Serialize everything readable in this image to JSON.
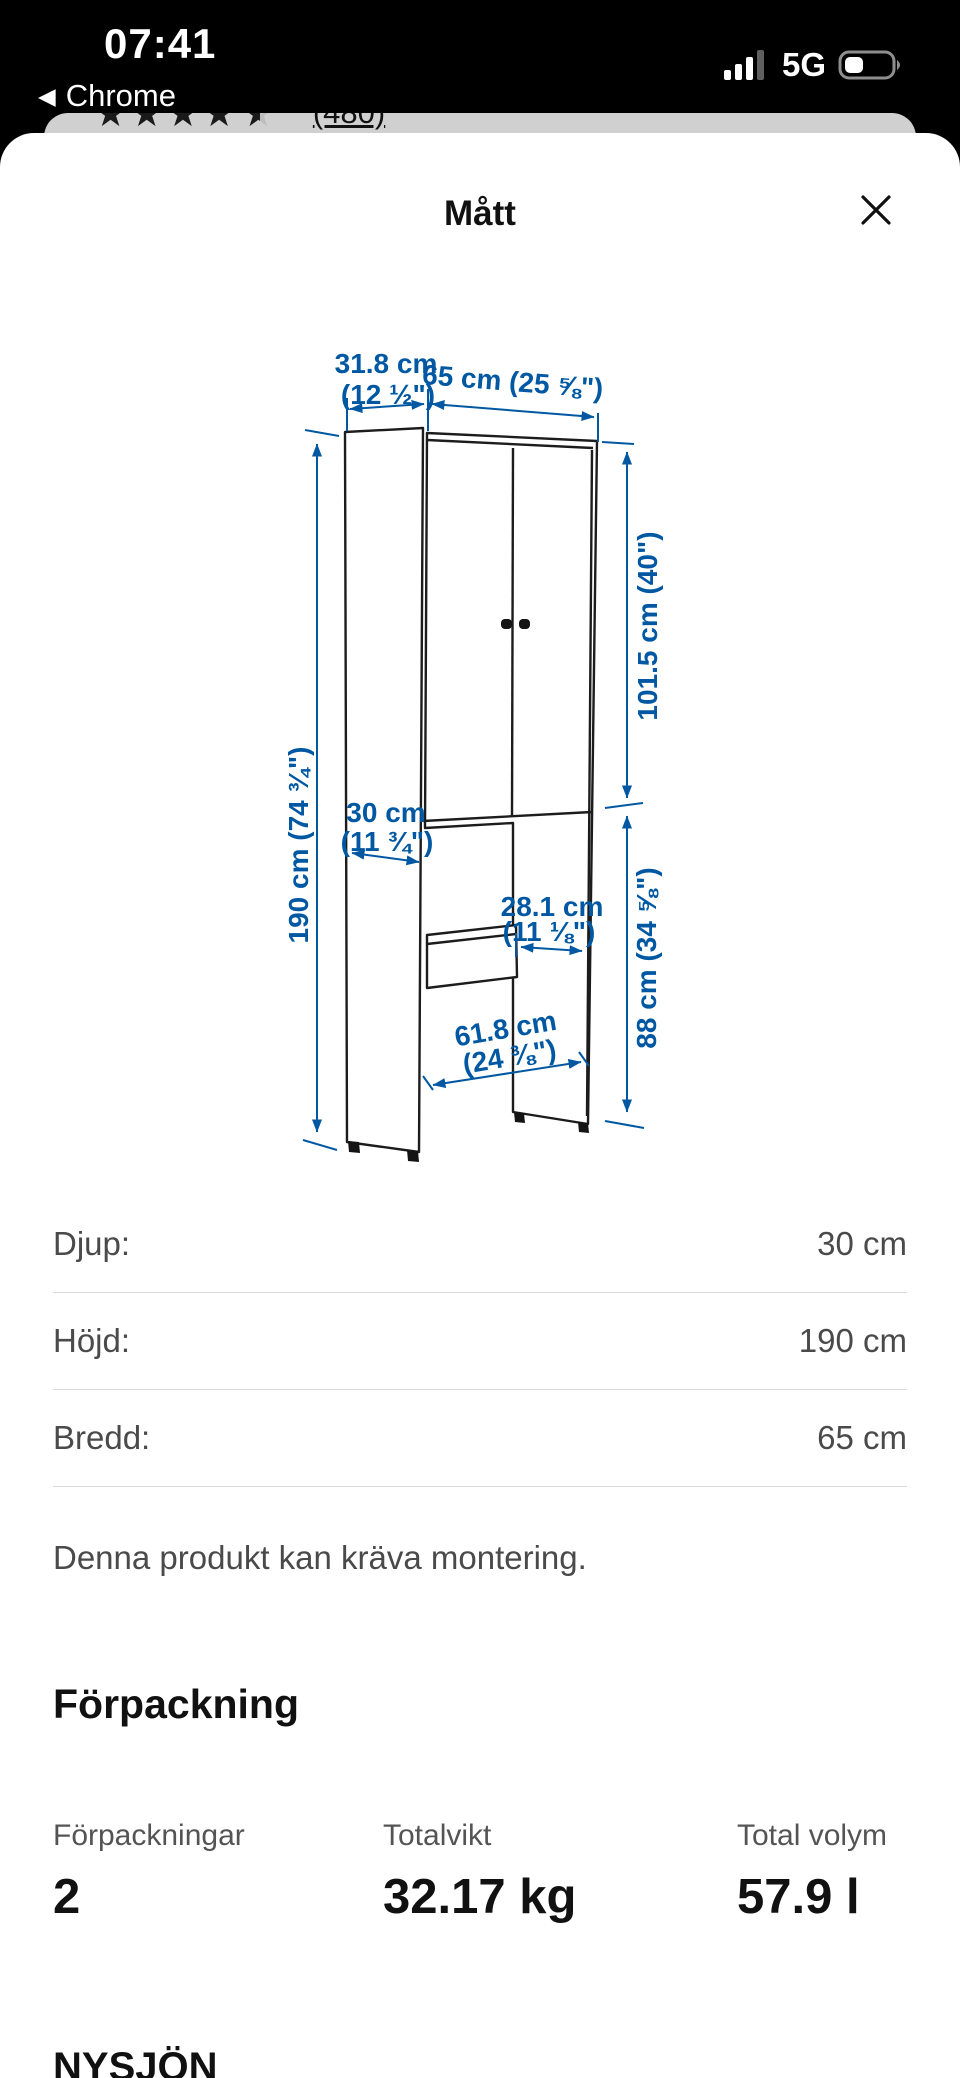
{
  "status_bar": {
    "time": "07:41",
    "network": "5G",
    "back_label": "Chrome"
  },
  "icons": {
    "back": "◀"
  },
  "background_page": {
    "stars_full": "★★★★",
    "star_half": "★",
    "rating_count": "(480)"
  },
  "modal": {
    "title": "Mått",
    "diagram": {
      "accent_color": "#0058a3",
      "labels": {
        "top_depth": {
          "line1": "31.8 cm",
          "line2": "(12 ½\")"
        },
        "total_width": "65 cm (25 ⅝\")",
        "total_height": "190 cm (74 ¾\")",
        "door_height": "101.5 cm (40\")",
        "base_depth": {
          "line1": "30 cm",
          "line2": "(11 ¾\")"
        },
        "panel_width": {
          "line1": "28.1 cm",
          "line2": "(11 ⅛\")"
        },
        "open_height": "88 cm (34 ⅝\")",
        "floor_width": {
          "line1": "61.8 cm",
          "line2": "(24 ⅜\")"
        }
      }
    },
    "specs": [
      {
        "label": "Djup:",
        "value": "30 cm"
      },
      {
        "label": "Höjd:",
        "value": "190 cm"
      },
      {
        "label": "Bredd:",
        "value": "65 cm"
      }
    ],
    "assembly_note": "Denna produkt kan kräva montering.",
    "packaging": {
      "heading": "Förpackning",
      "columns": [
        {
          "label": "Förpackningar",
          "value": "2"
        },
        {
          "label": "Totalvikt",
          "value": "32.17 kg"
        },
        {
          "label": "Total volym",
          "value": "57.9 l"
        }
      ]
    },
    "product_name": "NYSJÖN"
  }
}
